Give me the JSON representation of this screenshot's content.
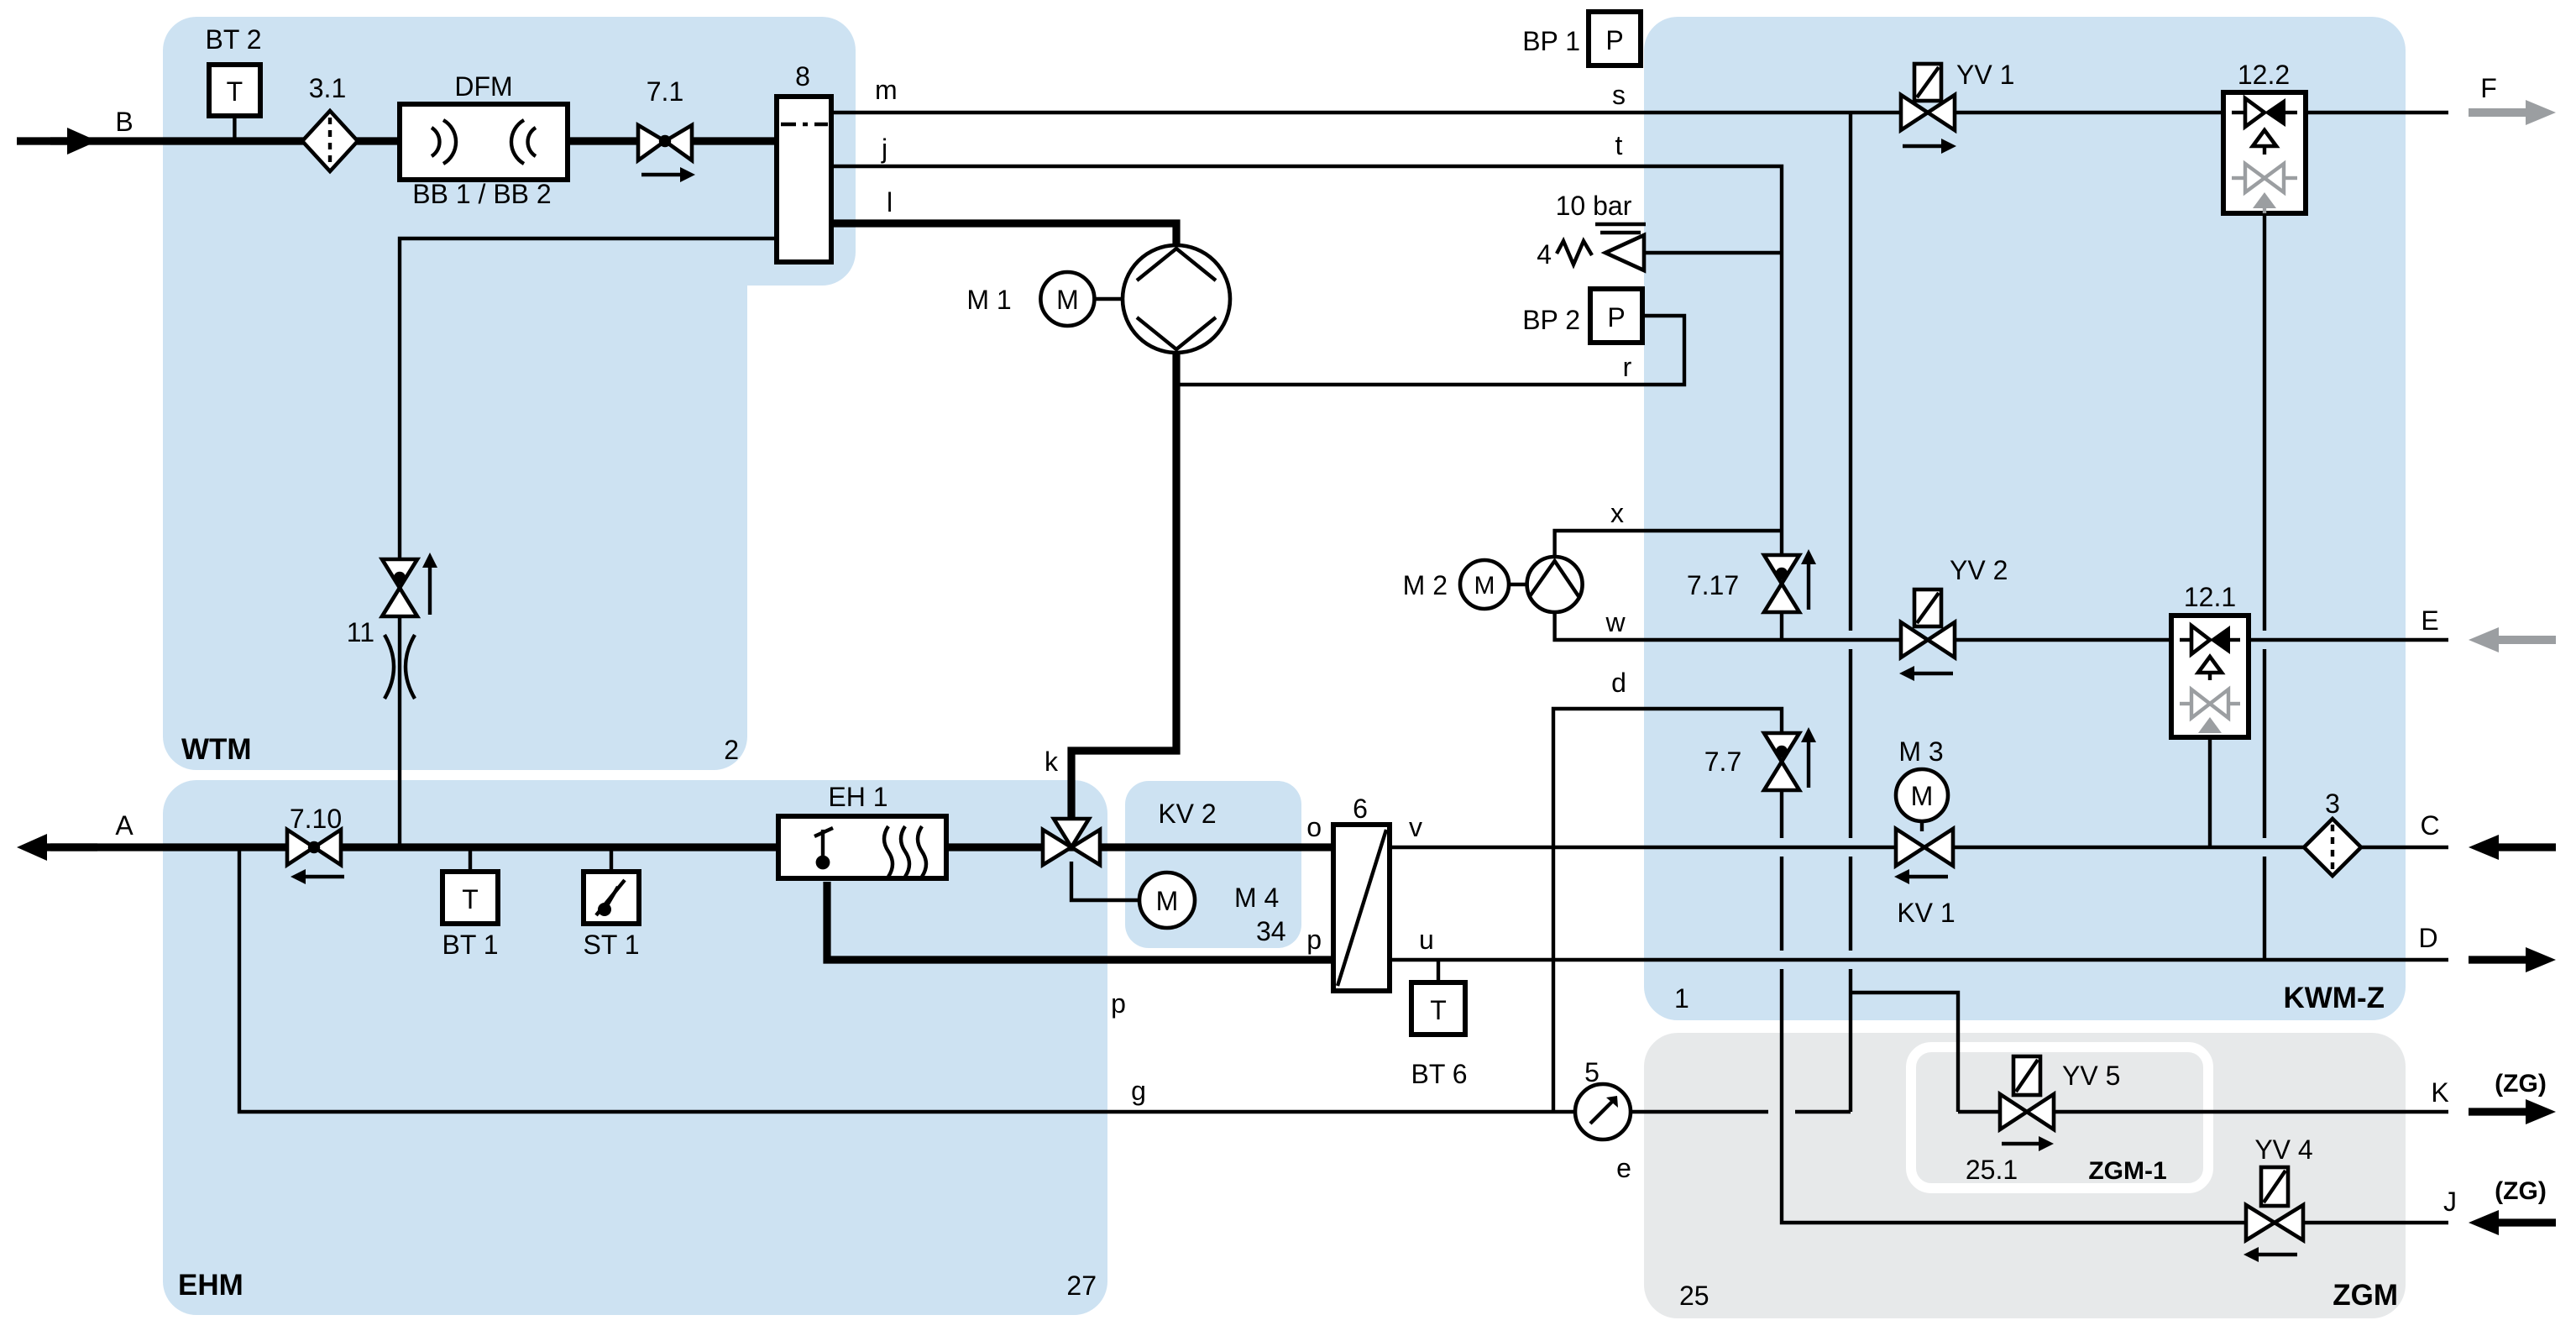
{
  "diagram_title": "Hydraulic / flow module schematic",
  "colors": {
    "line": "#000000",
    "gray_accent": "#9b9ea1",
    "module_blue": "#cde2f2",
    "module_gray": "#e7e9ea",
    "background": "#ffffff"
  },
  "modules": {
    "wtm": {
      "name": "WTM",
      "number": "2"
    },
    "ehm": {
      "name": "EHM",
      "number": "27"
    },
    "kwmz": {
      "name": "KWM-Z",
      "number": "1"
    },
    "zgm": {
      "name": "ZGM",
      "number": "25"
    },
    "zgm1": {
      "name": "ZGM-1",
      "number": "25.1"
    },
    "kv2box": {
      "name": "KV 2"
    }
  },
  "ports": {
    "a": "A",
    "b": "B",
    "c": "C",
    "d": "D",
    "e_line": "e",
    "f": "F",
    "eport": "E",
    "j": "J",
    "k": "K",
    "zg_k": "(ZG)",
    "zg_j": "(ZG)"
  },
  "line_labels": {
    "m": "m",
    "j": "j",
    "l": "l",
    "s": "s",
    "t": "t",
    "r": "r",
    "x": "x",
    "w": "w",
    "d": "d",
    "k": "k",
    "o": "o",
    "p_upper": "p",
    "p_lower": "p",
    "u": "u",
    "v": "v",
    "g": "g"
  },
  "components": {
    "bt2": {
      "label": "BT 2",
      "letter": "T"
    },
    "bt1": {
      "label": "BT 1",
      "letter": "T"
    },
    "bt6": {
      "label": "BT 6",
      "letter": "T"
    },
    "st1": {
      "label": "ST 1"
    },
    "bp1": {
      "label": "BP 1",
      "letter": "P"
    },
    "bp2": {
      "label": "BP 2",
      "letter": "P"
    },
    "filter31": {
      "label": "3.1"
    },
    "filter3": {
      "label": "3"
    },
    "dfm": {
      "label": "DFM",
      "sublabel": "BB 1 / BB 2"
    },
    "valve71": {
      "label": "7.1"
    },
    "valve710": {
      "label": "7.10"
    },
    "valve717": {
      "label": "7.17"
    },
    "valve77": {
      "label": "7.7"
    },
    "valve11": {
      "label": "11"
    },
    "valve4": {
      "label": "4",
      "setting": "10 bar"
    },
    "dist8": {
      "label": "8"
    },
    "hx6": {
      "label": "6"
    },
    "eh1": {
      "label": "EH 1"
    },
    "m1": {
      "label": "M 1",
      "letter": "M"
    },
    "m2": {
      "label": "M 2",
      "letter": "M"
    },
    "m3": {
      "label": "M 3",
      "letter": "M"
    },
    "m4": {
      "label": "M 4",
      "number": "34",
      "letter": "M"
    },
    "kv1": {
      "label": "KV 1"
    },
    "kv2": {
      "label": "KV 2"
    },
    "yv1": {
      "label": "YV 1"
    },
    "yv2": {
      "label": "YV 2"
    },
    "yv4": {
      "label": "YV 4"
    },
    "yv5": {
      "label": "YV 5"
    },
    "check122": {
      "label": "12.2"
    },
    "check121": {
      "label": "12.1"
    },
    "gauge5": {
      "label": "5"
    }
  }
}
